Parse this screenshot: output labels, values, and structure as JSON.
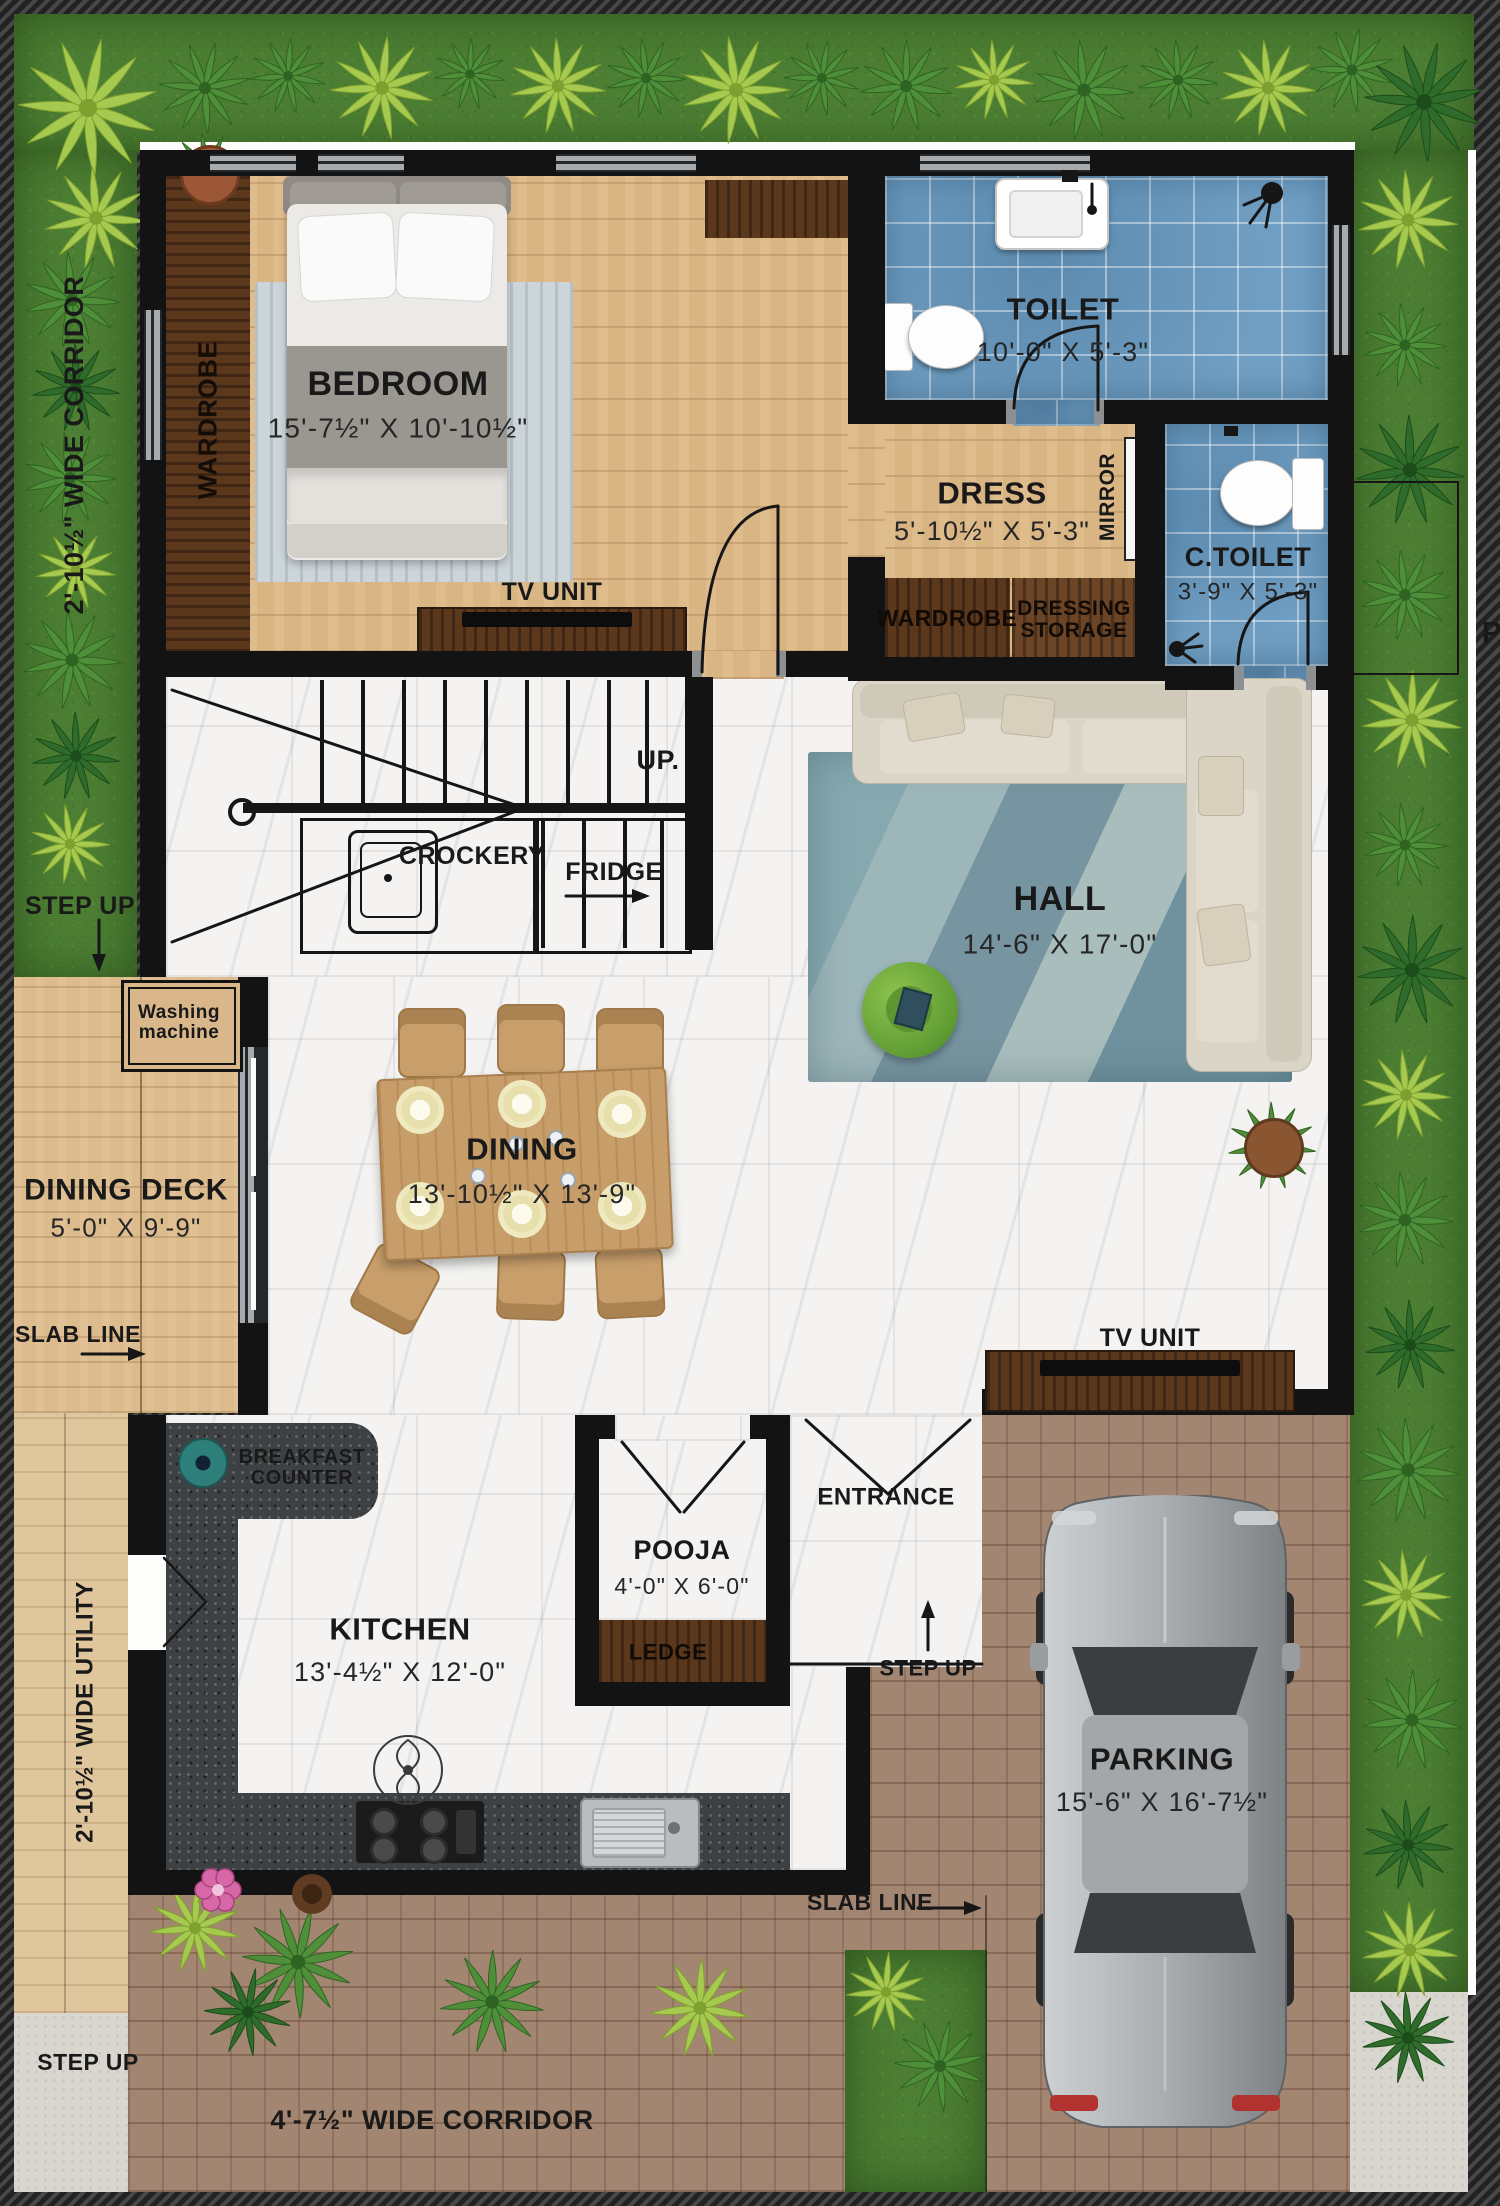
{
  "rooms": {
    "bedroom": {
      "name": "BEDROOM",
      "dims": "15'-7½\" X 10'-10½\""
    },
    "toilet": {
      "name": "TOILET",
      "dims": "10'-0\" X 5'-3\""
    },
    "dress": {
      "name": "DRESS",
      "dims": "5'-10½\" X 5'-3\""
    },
    "c_toilet": {
      "name": "C.TOILET",
      "dims": "3'-9\" X 5'-3\""
    },
    "hall": {
      "name": "HALL",
      "dims": "14'-6\" X 17'-0\""
    },
    "dining": {
      "name": "DINING",
      "dims": "13'-10½\" X 13'-9\""
    },
    "kitchen": {
      "name": "KITCHEN",
      "dims": "13'-4½\" X 12'-0\""
    },
    "pooja": {
      "name": "POOJA",
      "dims": "4'-0\" X 6'-0\""
    },
    "dining_deck": {
      "name": "DINING DECK",
      "dims": "5'-0\" X 9'-9\""
    },
    "parking": {
      "name": "PARKING",
      "dims": "15'-6\" X 16'-7½\""
    }
  },
  "furniture_labels": {
    "wardrobe": "WARDROBE",
    "tv_unit": "TV UNIT",
    "mirror": "MIRROR",
    "dressing_storage": "DRESSING STORAGE",
    "washing_machine": "Washing machine",
    "breakfast_counter": "BREAKFAST COUNTER",
    "crockery": "CROCKERY",
    "fridge": "FRIDGE",
    "ledge": "LEDGE"
  },
  "annotations": {
    "up": "UP.",
    "entrance": "ENTRANCE",
    "step_up": "STEP UP",
    "slab_line": "SLAB LINE",
    "corridor_left": "2'-10½\" WIDE CORRIDOR",
    "utility_left": "2'-10½\" WIDE UTILITY",
    "corridor_bottom": "4'-7½\" WIDE CORRIDOR",
    "boundary_letter": "P"
  },
  "colors": {
    "wall": "#131313",
    "grass": "#4c7e33",
    "tile": "#6f9ec2",
    "marble": "#f4f3f1",
    "wood_floor": "#d9b584",
    "dark_wood": "#5b371c",
    "brick": "#a38672",
    "granite": "#3e4144"
  }
}
